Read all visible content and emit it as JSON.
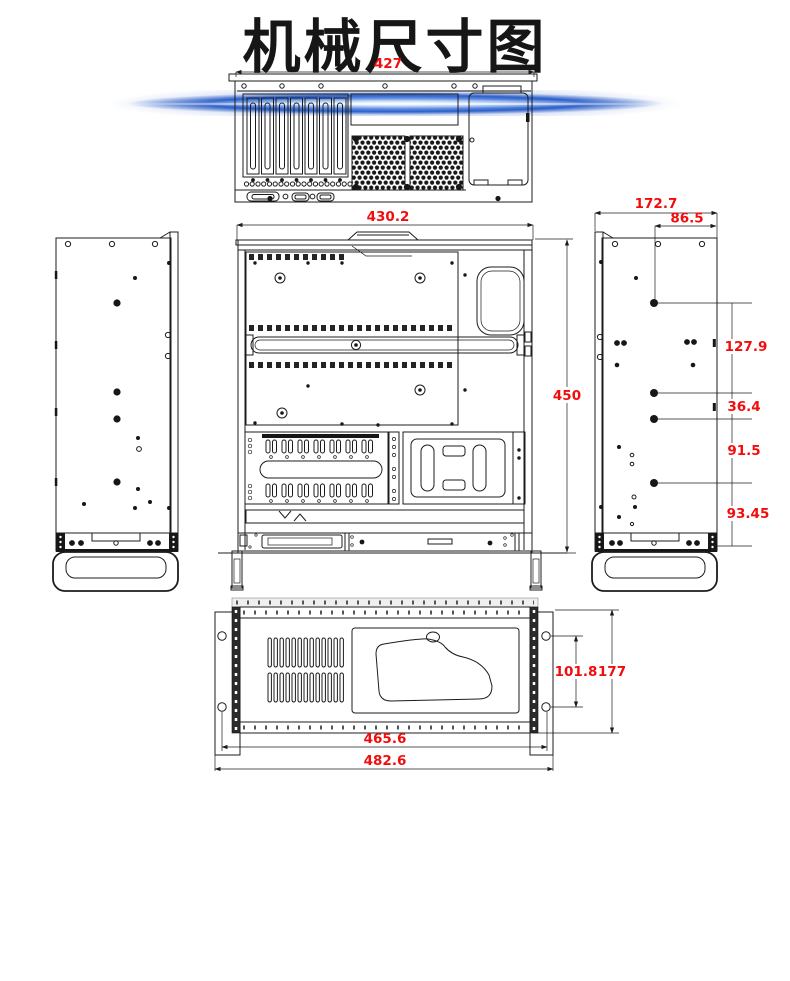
{
  "header": {
    "title": "机械尺寸图"
  },
  "colors": {
    "dimension_text": "#f20d0d",
    "line_art": "#1c1c1c",
    "divider_blue": "#2c5ec9",
    "background": "#ffffff"
  },
  "views": {
    "rear": {
      "label": "rear-panel-view",
      "width": "427"
    },
    "top": {
      "label": "top-view",
      "width": "430.2",
      "depth": "450"
    },
    "side": {
      "label": "side-view",
      "total_width": "172.7",
      "inner_width": "86.5",
      "seg1": "127.9",
      "seg2": "36.4",
      "seg3": "91.5",
      "seg4": "93.45"
    },
    "front": {
      "label": "front-panel-view",
      "inner_width": "465.6",
      "total_width": "482.6",
      "hole_spacing": "101.8",
      "height": "177"
    }
  }
}
